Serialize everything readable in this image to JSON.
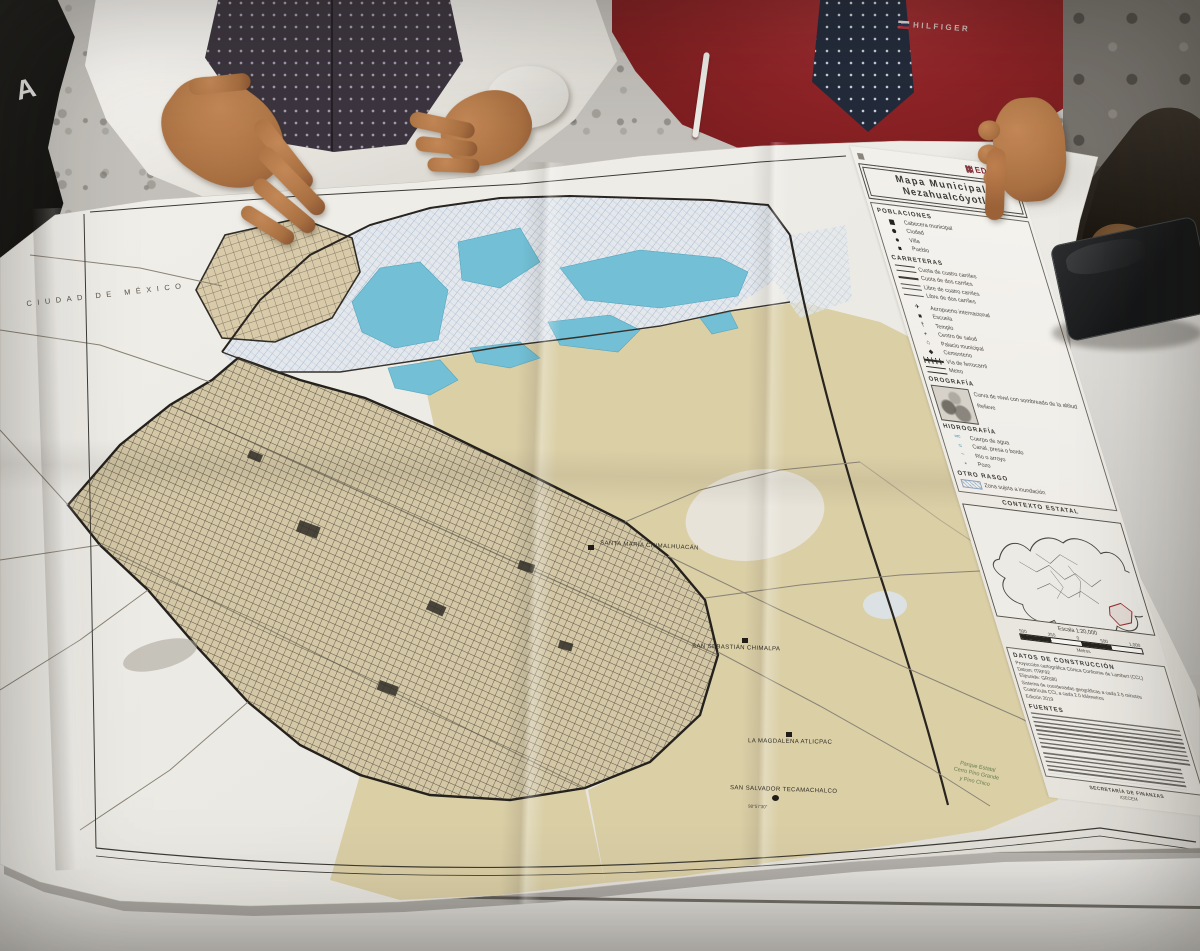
{
  "photo": {
    "chair_letter": "A",
    "jacket_brand": "HILFIGER"
  },
  "map_labels": {
    "region": "CIUDAD DE MÉXICO",
    "places": [
      {
        "name": "SANTA MARÍA CHIMALHUACÁN"
      },
      {
        "name": "SAN SEBASTIÁN CHIMALPA"
      },
      {
        "name": "LA MAGDALENA ATLICPAC"
      },
      {
        "name": "SAN SALVADOR TECAMACHALCO"
      }
    ],
    "coordinate": "98°57'30\"",
    "park": {
      "line1": "Parque Estatal",
      "line2": "Cerro Pino Grande",
      "line3": "y Pino Chico"
    }
  },
  "legend": {
    "logo_text": "EDOMEX",
    "title": {
      "line1": "Mapa Municipal",
      "line2": "Nezahualcóyotl"
    },
    "poblaciones": {
      "heading": "POBLACIONES",
      "items": [
        {
          "label": "Cabecera municipal"
        },
        {
          "label": "Ciudad"
        },
        {
          "label": "Villa"
        },
        {
          "label": "Pueblo"
        }
      ]
    },
    "carreteras": {
      "heading": "CARRETERAS",
      "items": [
        {
          "label": "Cuota de cuatro carriles"
        },
        {
          "label": "Cuota de dos carriles"
        },
        {
          "label": "Libre de cuatro carriles"
        },
        {
          "label": "Libre de dos carriles"
        }
      ]
    },
    "simbolos": {
      "items": [
        {
          "glyph": "✈",
          "label": "Aeropuerto internacional"
        },
        {
          "glyph": "■",
          "label": "Escuela"
        },
        {
          "glyph": "†",
          "label": "Templo"
        },
        {
          "glyph": "+",
          "label": "Centro de salud"
        },
        {
          "glyph": "⌂",
          "label": "Palacio municipal"
        },
        {
          "glyph": "◆",
          "label": "Cementerio"
        },
        {
          "label": "Vía de ferrocarril"
        },
        {
          "label": "Metro"
        }
      ]
    },
    "orografia": {
      "heading": "OROGRAFÍA",
      "label1": "Curva de nivel con sombreado de la altitud",
      "label2": "Relieve"
    },
    "hidrografia": {
      "heading": "HIDROGRAFÍA",
      "items": [
        {
          "glyph": "≈≈",
          "label": "Cuerpo de agua"
        },
        {
          "glyph": "≈",
          "label": "Canal, presa o bordo"
        },
        {
          "glyph": "~",
          "label": "Río o arroyo"
        },
        {
          "glyph": "•",
          "label": "Pozo"
        }
      ]
    },
    "otro": {
      "heading": "OTRO RASGO",
      "items": [
        {
          "label": "Zona sujeta a inundación"
        }
      ]
    },
    "contexto": {
      "heading": "CONTEXTO ESTATAL"
    },
    "scale": {
      "title": "Escala 1:20,000",
      "ticks": [
        "500",
        "250",
        "0",
        "500",
        "1,000"
      ],
      "unit": "Metros"
    },
    "datos": {
      "heading": "DATOS DE CONSTRUCCIÓN",
      "lines": [
        "Proyección cartográfica Cónica Conforme de Lambert (CCL)",
        "Datum: ITRF92",
        "Elipsoide: GRS80",
        "Sistema de coordenadas geográficas a cada 2.5 minutos",
        "Cuadrícula CCL a cada 2.0 kilómetros",
        "Edición 2019"
      ]
    },
    "fuentes": {
      "heading": "FUENTES"
    },
    "footer": {
      "line1": "SECRETARÍA DE FINANZAS",
      "line2": "IGECEM"
    }
  },
  "colors": {
    "paper": "#f2f1ed",
    "water": "#72c3dc",
    "urban_base": "#d6cbaa",
    "rural": "#ded3ab",
    "flood_hatch": "#a3bad4",
    "jacket_red": "#8b2026",
    "edomex_maroon": "#7a2430",
    "park_green": "#637e4e"
  }
}
